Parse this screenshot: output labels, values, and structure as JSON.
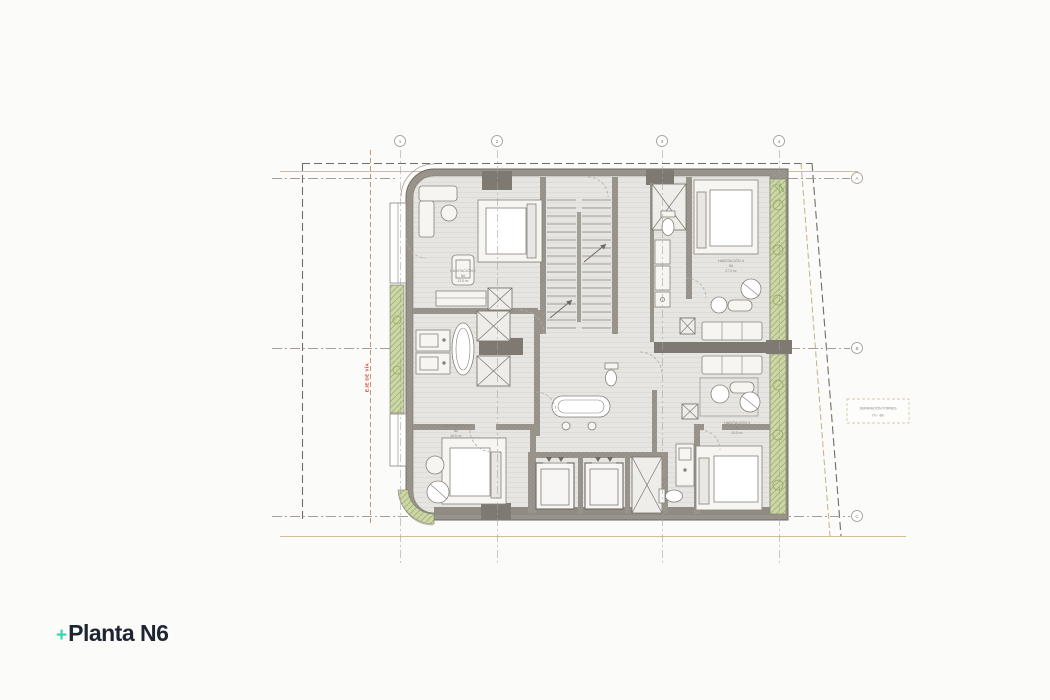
{
  "title": {
    "plus": "+",
    "text": "Planta N6"
  },
  "plan": {
    "grid": {
      "top_bubbles": [
        "1",
        "2",
        "3",
        "4"
      ],
      "right_bubbles": [
        "A",
        "B",
        "C"
      ]
    },
    "rooms": {
      "hab2": {
        "name": "HABITACIÓN 2",
        "level": "N6",
        "area": "23.5 m²"
      },
      "hab4": {
        "name": "HABITACIÓN 4",
        "level": "N6",
        "area": "27.5 m²"
      },
      "hab1": {
        "name": "HABITACIÓN 1",
        "level": "N6",
        "area": "26.5 m²"
      },
      "hab3": {
        "name": "HABITACIÓN 3",
        "level": "N6",
        "area": "24.5 m²"
      }
    },
    "notes": {
      "red_note": "EJE DE VÍA",
      "separation1": "SEPARACIÓN TORRES",
      "separation2": "7m - 8m"
    },
    "colors": {
      "accent": "#2fd5b0",
      "ink": "#1c2531",
      "wall": "#9a958d",
      "wall_dark": "#7e7971",
      "floor": "#e6e5e1",
      "planter_green": "#ccd6a6",
      "red_note": "#d03a2e",
      "tan_guide": "#cfc093"
    }
  }
}
